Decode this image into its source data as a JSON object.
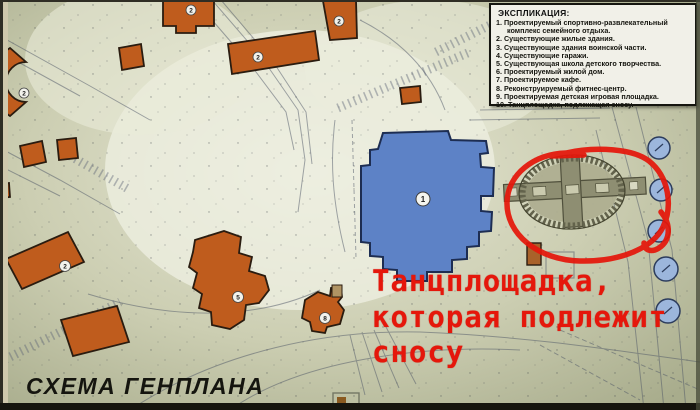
{
  "title": "СХЕМА ГЕНПЛАНА",
  "legend": {
    "title": "ЭКСПЛИКАЦИЯ:",
    "items": [
      "1. Проектируемый спортивно-развлекательный комплекс семейного отдыха.",
      "2. Существующие жилые здания.",
      "3. Существующие здания воинской части.",
      "4. Существующие гаражи.",
      "5. Существующая школа детского творчества.",
      "6. Проектируемый жилой дом.",
      "7. Проектируемое кафе.",
      "8. Реконструируемый фитнес-центр.",
      "9. Проектируемая детская игровая площадка.",
      "10. Танцплощадка, подлежащая сносу."
    ]
  },
  "annotation": {
    "line1": "Танцплощадка,",
    "line2": "которая подлежит",
    "line3": "сносу",
    "color": "#e5170b"
  },
  "map": {
    "building_labels": [
      {
        "name": "residential-arc",
        "text": "2"
      },
      {
        "name": "residential-top",
        "text": "2"
      },
      {
        "name": "residential-row",
        "text": "2"
      },
      {
        "name": "residential-vertical",
        "text": "2"
      },
      {
        "name": "residential-diagonal",
        "text": "2"
      },
      {
        "name": "school",
        "text": "5"
      },
      {
        "name": "fitness-center",
        "text": "8"
      },
      {
        "name": "sports-complex",
        "text": "1"
      }
    ]
  },
  "colors": {
    "background_olive": "#c6c9ae",
    "building_orange": "#bf5c1d",
    "main_building_blue": "#5d82c6",
    "annotation_red": "#e5170b",
    "legend_background": "#f1f0e8",
    "tree_blue": "#9cb6dc"
  }
}
